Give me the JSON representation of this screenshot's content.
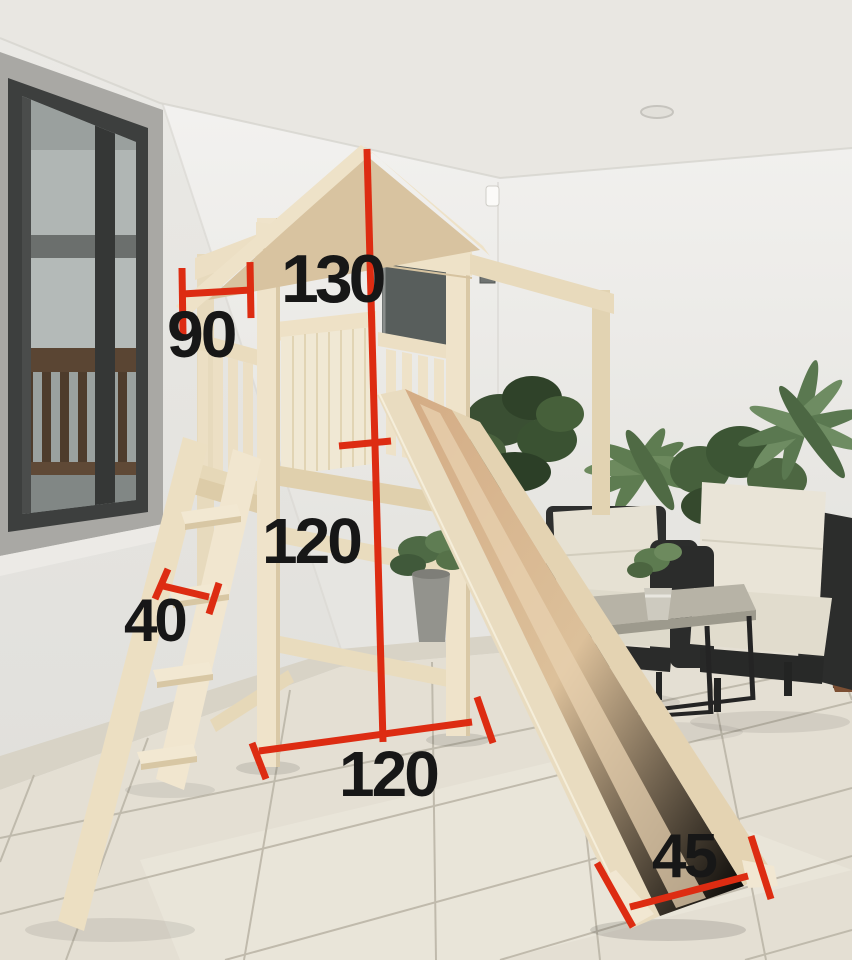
{
  "dimension_labels": {
    "top": "130",
    "upper_left": "90",
    "mid": "120",
    "ladder": "40",
    "bottom": "120",
    "slide": "45"
  },
  "colors": {
    "dimension_line": "#dd2c12",
    "dimension_text": "#171717",
    "structure_wood": "#ece0c6",
    "slide_wood": "#d8bb93",
    "wall": "#ebeae7",
    "floor_tile": "#e4dfd3"
  }
}
